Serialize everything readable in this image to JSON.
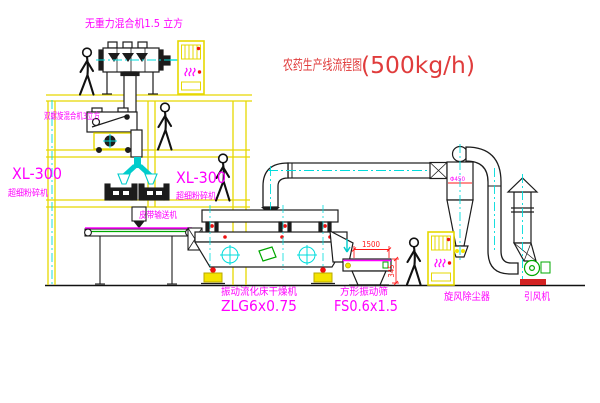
{
  "title": {
    "prefix": "农药生产线流程图",
    "capacity": "(500kg/h)"
  },
  "labels": {
    "top_mixer": "无重力混合机1.5 立方",
    "screw_mixer": "双螺旋混合机3立方",
    "mill_left_model": "XL-300",
    "mill_left_name": "超细粉碎机",
    "mill_center_model": "XL-300",
    "mill_center_name": "超细粉碎机",
    "belt_conveyor": "皮带输送机",
    "dryer_name": "振动流化床干燥机",
    "dryer_model": "ZLG6x0.75",
    "sifter_name": "方形振动筛",
    "sifter_model": "FS0.6x1.5",
    "cyclone": "旋风除尘器",
    "fan": "引风机"
  },
  "dimensions": {
    "sifter_width": "1500",
    "sifter_height": "345",
    "cyclone_dia": "Φ450"
  },
  "colors": {
    "structure_yellow": "#e6d800",
    "centerline_cyan": "#00dcdc",
    "label_magenta": "#ff00ff",
    "title_red": "#e03c3c",
    "dimension_red": "#ff1a1a",
    "machine_line": "#1c1c1c",
    "accent_green": "#00a800"
  }
}
